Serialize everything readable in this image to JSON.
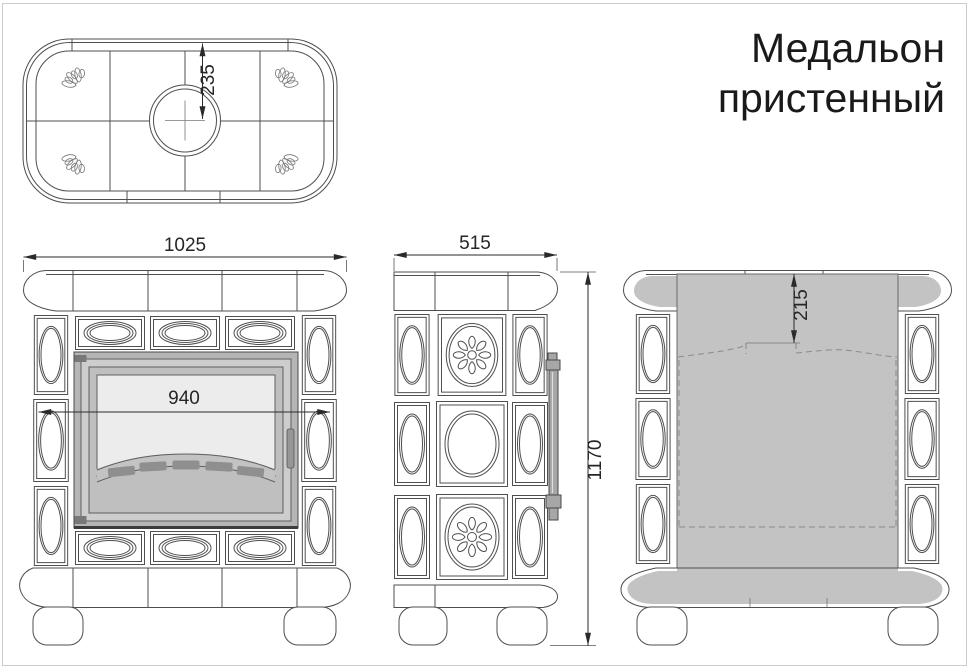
{
  "title": {
    "line1": "Медальон",
    "line2": "пристенный"
  },
  "dimensions": {
    "chimney_center_offset": "235",
    "overall_width": "1025",
    "firebox_door_width": "940",
    "depth": "515",
    "overall_height": "1170",
    "rear_flue_offset": "215"
  },
  "colors": {
    "outline": "#4f4f4f",
    "dim": "#2a2a2a",
    "panel-gray": "#c3c3c3",
    "door-frame": "#b5b5b5",
    "door-face": "#cdcdcd",
    "door-inner": "#bfbfbf",
    "glass": "#ececec",
    "slot": "#8f8f8f",
    "hardware": "#a7a7a7",
    "dark-line": "#3c3c3c",
    "dashed": "#8a8a8a",
    "page-border": "#cccccc",
    "title-color": "#1a1a1a"
  }
}
